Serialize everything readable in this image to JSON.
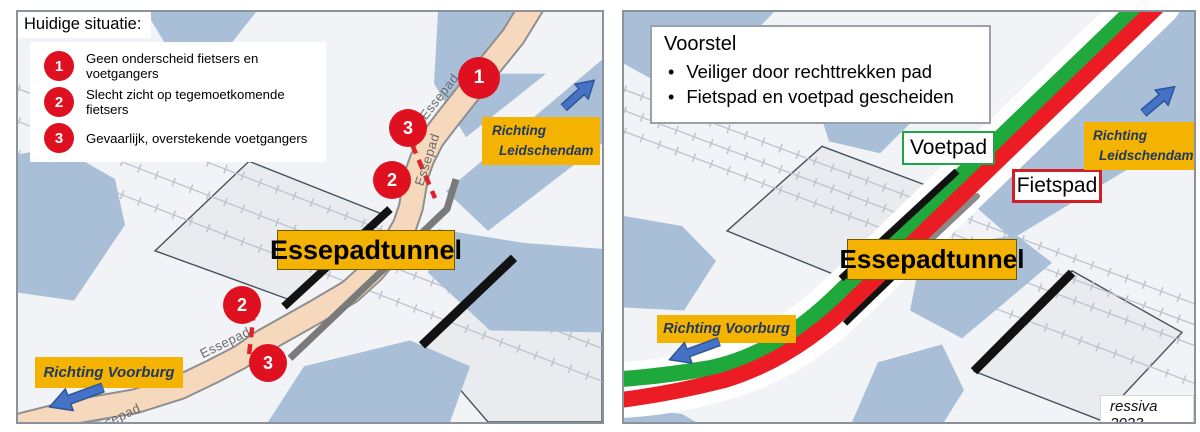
{
  "colors": {
    "gold": "#F3B300",
    "marker_red": "#DF1020",
    "path_tan": "#F6D8BC",
    "water_blue": "#A9BFD8",
    "green_path": "#1FA83C",
    "red_path": "#EC1C24",
    "navy_text": "#1F3864",
    "arrow_blue": "#4472C4"
  },
  "left_panel": {
    "title": "Huidige situatie:",
    "legend_items": [
      {
        "num": "1",
        "text": "Geen onderscheid fietsers en voetgangers"
      },
      {
        "num": "2",
        "text": "Slecht zicht op tegemoetkomende fietsers"
      },
      {
        "num": "3",
        "text": "Gevaarlijk, overstekende voetgangers"
      }
    ],
    "path_label": "Essepad",
    "tunnel_label": "Essepadtunnel",
    "direction_ne": {
      "line1": "Richting",
      "line2": "Leidschendam"
    },
    "direction_sw": "Richting Voorburg",
    "markers": [
      {
        "label": "1"
      },
      {
        "label": "3"
      },
      {
        "label": "2"
      },
      {
        "label": "2"
      },
      {
        "label": "3"
      }
    ]
  },
  "right_panel": {
    "title": "Voorstel",
    "bullets": [
      "Veiliger door rechttrekken pad",
      "Fietspad en voetpad gescheiden"
    ],
    "voetpad_label": "Voetpad",
    "fietspad_label": "Fietspad",
    "tunnel_label": "Essepadtunnel",
    "direction_ne": {
      "line1": "Richting",
      "line2": "Leidschendam"
    },
    "direction_sw": "Richting Voorburg",
    "credit": "ressiva 2023"
  }
}
